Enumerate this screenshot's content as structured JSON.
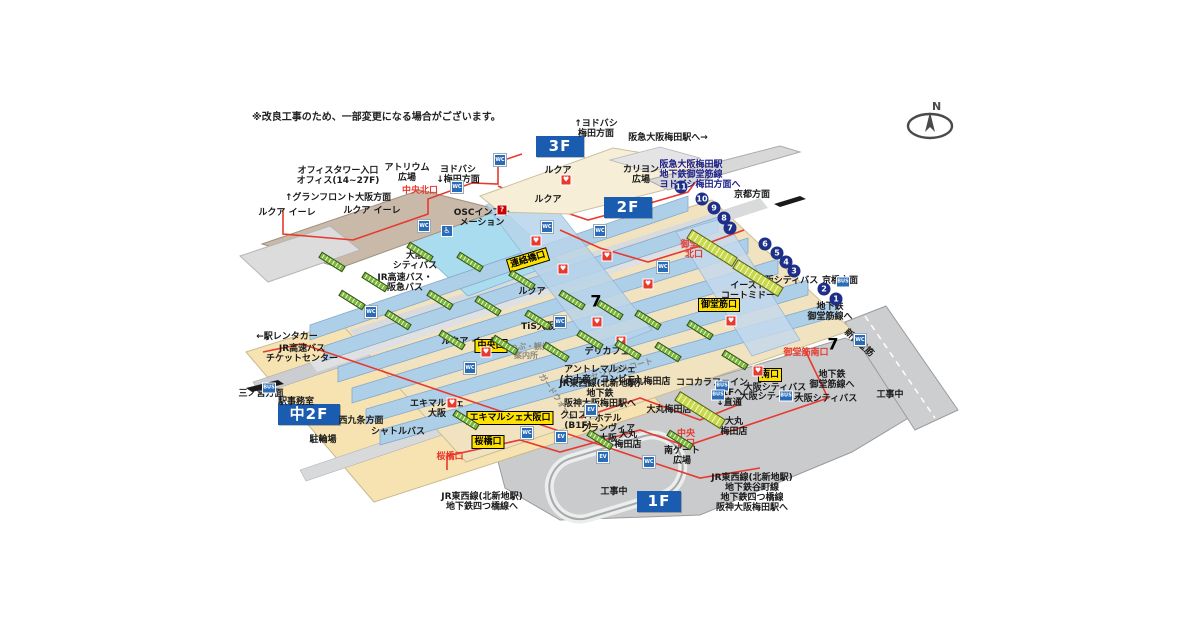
{
  "meta": {
    "title": "JR大阪駅 構内図(立体)",
    "note": "※改良工事のため、一部変更になる場合がございます。",
    "compass_label": "N"
  },
  "colors": {
    "floor_badge_blue": "#1a5cb0",
    "exit_badge_yellow": "#ffe100",
    "route_red": "#e8392e",
    "platform_blue": "#aecfe8",
    "concourse_beige": "#f2e3c0",
    "mezzanine_beige": "#f7e3b2",
    "road_gray": "#c9cbcd",
    "roof_cream": "#f6eed6",
    "roof_brown": "#c9b9a9",
    "atrium_cyan": "#a9dcee",
    "escalator_green": "#7db93c",
    "number_navy": "#1d2f88",
    "navy_text": "#1d2088"
  },
  "floor_badges": [
    {
      "name": "floor-badge-3f",
      "label": "3F",
      "x": 536,
      "y": 136,
      "w": 48
    },
    {
      "name": "floor-badge-2f",
      "label": "2F",
      "x": 604,
      "y": 197,
      "w": 48
    },
    {
      "name": "floor-badge-naka2f",
      "label": "中2F",
      "x": 278,
      "y": 404,
      "w": 62
    },
    {
      "name": "floor-badge-1f",
      "label": "1F",
      "x": 637,
      "y": 491,
      "w": 44
    }
  ],
  "labels": [
    {
      "name": "office-tower-entrance",
      "text": "オフィスタワー入口\nオフィス(14~27F)",
      "x": 338,
      "y": 177,
      "cls": "lbl"
    },
    {
      "name": "atrium-plaza",
      "text": "アトリウム\n広場",
      "x": 407,
      "y": 174,
      "cls": "lbl"
    },
    {
      "name": "yodobashi-umeda-down",
      "text": "ヨドバシ\n↓梅田方面",
      "x": 458,
      "y": 176,
      "cls": "lbl"
    },
    {
      "name": "chuo-north-exit",
      "text": "中央北口",
      "x": 420,
      "y": 192,
      "cls": "lbl-red"
    },
    {
      "name": "grand-front-osaka-direction",
      "text": "↑グランフロント大阪方面",
      "x": 338,
      "y": 199,
      "cls": "lbl"
    },
    {
      "name": "lucua-eere-west",
      "text": "ルクア イーレ",
      "x": 287,
      "y": 214,
      "cls": "lbl"
    },
    {
      "name": "lucua-eere-east",
      "text": "ルクア イーレ",
      "x": 372,
      "y": 212,
      "cls": "lbl"
    },
    {
      "name": "lucua-eere-mid",
      "text": "ルクア イーレ",
      "x": 470,
      "y": 343,
      "cls": "lbl"
    },
    {
      "name": "yodobashi-umeda-up",
      "text": "↑ヨドバシ\n梅田方面",
      "x": 596,
      "y": 130,
      "cls": "lbl"
    },
    {
      "name": "lucua-3f",
      "text": "ルクア",
      "x": 558,
      "y": 172,
      "cls": "lbl"
    },
    {
      "name": "lucua-2f",
      "text": "ルクア",
      "x": 548,
      "y": 201,
      "cls": "lbl"
    },
    {
      "name": "lucua-2f-lower",
      "text": "ルクア",
      "x": 532,
      "y": 293,
      "cls": "lbl"
    },
    {
      "name": "hankyu-osaka-umeda-sta",
      "text": "阪急大阪梅田駅へ→",
      "x": 668,
      "y": 139,
      "cls": "lbl"
    },
    {
      "name": "carillon-plaza",
      "text": "カリヨン\n広場",
      "x": 641,
      "y": 176,
      "cls": "lbl"
    },
    {
      "name": "hankyu-subway-yodobashi-route",
      "text": "阪急大阪梅田駅\n地下鉄御堂筋線\nヨドバシ梅田方面へ",
      "x": 700,
      "y": 176,
      "cls": "lbl-navy"
    },
    {
      "name": "kyoto-direction",
      "text": "京都方面",
      "x": 752,
      "y": 196,
      "cls": "lbl"
    },
    {
      "name": "osc-information",
      "text": "OSCインフォ\nメーション",
      "x": 482,
      "y": 219,
      "cls": "lbl"
    },
    {
      "name": "osaka-city-bus-west",
      "text": "大阪\nシティバス",
      "x": 415,
      "y": 262,
      "cls": "lbl"
    },
    {
      "name": "jr-highway-hankyu-bus",
      "text": "JR高速バス・\n阪急バス",
      "x": 405,
      "y": 284,
      "cls": "lbl"
    },
    {
      "name": "renrakubashi-exit",
      "text": "連絡橋口",
      "x": 528,
      "y": 260,
      "cls": "badge",
      "rot": -17
    },
    {
      "name": "midosuji-north-exit",
      "text": "御堂筋\n北口",
      "x": 694,
      "y": 251,
      "cls": "lbl-red"
    },
    {
      "name": "osaka-city-bus-east",
      "text": "大阪シティバス",
      "x": 787,
      "y": 282,
      "cls": "lbl"
    },
    {
      "name": "kyobashi-direction",
      "text": "京橋方面",
      "x": 840,
      "y": 282,
      "cls": "lbl"
    },
    {
      "name": "east-court-mido",
      "text": "イースト\nコートミドー",
      "x": 748,
      "y": 292,
      "cls": "lbl"
    },
    {
      "name": "subway-midosuji-northeast",
      "text": "地下鉄\n御堂筋線へ",
      "x": 830,
      "y": 313,
      "cls": "lbl"
    },
    {
      "name": "midosuji-exit",
      "text": "御堂筋口",
      "x": 719,
      "y": 305,
      "cls": "badge"
    },
    {
      "name": "shin-midosuji-road",
      "text": "新御堂筋",
      "x": 858,
      "y": 344,
      "cls": "lbl",
      "rot": 42
    },
    {
      "name": "midosuji-south-exit",
      "text": "御堂筋南口",
      "x": 806,
      "y": 354,
      "cls": "lbl-red"
    },
    {
      "name": "subway-midosuji-southeast",
      "text": "地下鉄\n御堂筋線へ",
      "x": 832,
      "y": 381,
      "cls": "lbl"
    },
    {
      "name": "under-construction-east",
      "text": "工事中",
      "x": 890,
      "y": 396,
      "cls": "lbl"
    },
    {
      "name": "minami-exit",
      "text": "南口",
      "x": 770,
      "y": 375,
      "cls": "badge"
    },
    {
      "name": "osaka-city-bus-south1",
      "text": "大阪シティバス",
      "x": 775,
      "y": 389,
      "cls": "lbl"
    },
    {
      "name": "osaka-city-bus-south2",
      "text": "大阪シティバス",
      "x": 771,
      "y": 398,
      "cls": "lbl"
    },
    {
      "name": "osaka-city-bus-south3",
      "text": "大阪シティバス",
      "x": 826,
      "y": 400,
      "cls": "lbl"
    },
    {
      "name": "cocokara-fine",
      "text": "ココカラファイン",
      "x": 712,
      "y": 384,
      "cls": "lbl"
    },
    {
      "name": "b1f-direct",
      "text": "B1Fへ\n↓直通",
      "x": 729,
      "y": 399,
      "cls": "lbl"
    },
    {
      "name": "deli-cafe",
      "text": "デリカフェ",
      "x": 607,
      "y": 353,
      "cls": "lbl"
    },
    {
      "name": "central-court",
      "text": "セントラルコート",
      "x": 622,
      "y": 370,
      "cls": "lbl-gray",
      "rot": -15
    },
    {
      "name": "daimaru-umeda-1",
      "text": "大丸梅田店",
      "x": 648,
      "y": 383,
      "cls": "lbl"
    },
    {
      "name": "daimaru-umeda-2",
      "text": "大丸梅田店",
      "x": 669,
      "y": 411,
      "cls": "lbl"
    },
    {
      "name": "daimaru-umeda-3",
      "text": "大丸\n梅田店",
      "x": 628,
      "y": 441,
      "cls": "lbl"
    },
    {
      "name": "daimaru-umeda-4",
      "text": "大丸\n梅田店",
      "x": 734,
      "y": 428,
      "cls": "lbl"
    },
    {
      "name": "entree-marche",
      "text": "アントレマルシェ\n(お土産・コンビニ)",
      "x": 600,
      "y": 376,
      "cls": "lbl"
    },
    {
      "name": "jr-tozai-route-center",
      "text": "JR東西線(北新地駅)\n地下鉄\n阪神大阪梅田駅へ",
      "x": 600,
      "y": 395,
      "cls": "lbl"
    },
    {
      "name": "gard-walk",
      "text": "ガードウォーク",
      "x": 556,
      "y": 398,
      "cls": "lbl-gray",
      "rot": 55
    },
    {
      "name": "crost-b1f",
      "text": "クロスト\n(B1F)",
      "x": 578,
      "y": 422,
      "cls": "lbl"
    },
    {
      "name": "hotel-granvia-osaka",
      "text": "ホテル\nグランヴィア\n大阪",
      "x": 608,
      "y": 430,
      "cls": "lbl"
    },
    {
      "name": "chuo-south-exit",
      "text": "中央\n南口",
      "x": 686,
      "y": 440,
      "cls": "lbl-red"
    },
    {
      "name": "south-gate-plaza",
      "text": "南ゲート\n広場",
      "x": 682,
      "y": 457,
      "cls": "lbl"
    },
    {
      "name": "jr-tozai-route-southeast",
      "text": "JR東西線(北新地駅)\n地下鉄谷町線\n地下鉄四つ橋線\n阪神大阪梅田駅へ",
      "x": 752,
      "y": 494,
      "cls": "lbl"
    },
    {
      "name": "jr-tozai-route-southwest",
      "text": "JR東西線(北新地駅)\n地下鉄四つ橋線へ",
      "x": 482,
      "y": 503,
      "cls": "lbl"
    },
    {
      "name": "under-construction-south",
      "text": "工事中",
      "x": 614,
      "y": 493,
      "cls": "lbl"
    },
    {
      "name": "station-rentacar",
      "text": "←駅レンタカー",
      "x": 287,
      "y": 338,
      "cls": "lbl"
    },
    {
      "name": "jr-highway-bus-ticket-center",
      "text": "JR高速バス\nチケットセンター",
      "x": 302,
      "y": 355,
      "cls": "lbl"
    },
    {
      "name": "sannomiya-direction",
      "text": "三ノ宮方面",
      "x": 261,
      "y": 395,
      "cls": "lbl"
    },
    {
      "name": "station-office",
      "text": "駅事務室",
      "x": 296,
      "y": 403,
      "cls": "lbl"
    },
    {
      "name": "nishikujo-direction",
      "text": "西九条方面",
      "x": 361,
      "y": 422,
      "cls": "lbl"
    },
    {
      "name": "shuttle-bus",
      "text": "シャトルバス",
      "x": 398,
      "y": 433,
      "cls": "lbl"
    },
    {
      "name": "bicycle-parking",
      "text": "駐輪場",
      "x": 323,
      "y": 441,
      "cls": "lbl"
    },
    {
      "name": "ekimaruche-osaka",
      "text": "エキマルシェ\n大阪",
      "x": 437,
      "y": 410,
      "cls": "lbl"
    },
    {
      "name": "ekimaruche-osaka-exit",
      "text": "エキマルシェ大阪口",
      "x": 510,
      "y": 418,
      "cls": "badge"
    },
    {
      "name": "sakurabashi-exit-badge",
      "text": "桜橋口",
      "x": 488,
      "y": 442,
      "cls": "badge"
    },
    {
      "name": "sakurabashi-exit-red",
      "text": "桜橋口",
      "x": 450,
      "y": 458,
      "cls": "lbl-red"
    },
    {
      "name": "chuo-exit",
      "text": "中央口",
      "x": 491,
      "y": 346,
      "cls": "badge"
    },
    {
      "name": "tis-osaka",
      "text": "TiS大阪",
      "x": 538,
      "y": 328,
      "cls": "lbl"
    },
    {
      "name": "ticket-tourist-info",
      "text": "きっぷ・観光\n案内所",
      "x": 526,
      "y": 352,
      "cls": "lbl-gray"
    }
  ],
  "platform_numbers": [
    {
      "n": "11",
      "x": 681,
      "y": 187
    },
    {
      "n": "10",
      "x": 702,
      "y": 199
    },
    {
      "n": "9",
      "x": 714,
      "y": 208
    },
    {
      "n": "8",
      "x": 724,
      "y": 218
    },
    {
      "n": "7",
      "x": 730,
      "y": 228
    },
    {
      "n": "6",
      "x": 765,
      "y": 244
    },
    {
      "n": "5",
      "x": 777,
      "y": 253
    },
    {
      "n": "4",
      "x": 786,
      "y": 262
    },
    {
      "n": "3",
      "x": 794,
      "y": 271
    },
    {
      "n": "2",
      "x": 824,
      "y": 289
    },
    {
      "n": "1",
      "x": 836,
      "y": 299
    }
  ],
  "icon_glyphs": {
    "restroom": "WC",
    "elevator": "EV",
    "aed": "♥",
    "info": "?",
    "seven-eleven": "7",
    "bus": "BUS",
    "wheelchair": "♿"
  },
  "icons": [
    {
      "type": "restroom",
      "x": 500,
      "y": 160
    },
    {
      "type": "restroom",
      "x": 457,
      "y": 187
    },
    {
      "type": "restroom",
      "x": 424,
      "y": 226
    },
    {
      "type": "restroom",
      "x": 547,
      "y": 227
    },
    {
      "type": "restroom",
      "x": 600,
      "y": 231
    },
    {
      "type": "restroom",
      "x": 663,
      "y": 267
    },
    {
      "type": "restroom",
      "x": 560,
      "y": 322
    },
    {
      "type": "restroom",
      "x": 371,
      "y": 312
    },
    {
      "type": "restroom",
      "x": 470,
      "y": 368
    },
    {
      "type": "restroom",
      "x": 527,
      "y": 433
    },
    {
      "type": "restroom",
      "x": 649,
      "y": 462
    },
    {
      "type": "restroom",
      "x": 860,
      "y": 340
    },
    {
      "type": "wheelchair",
      "x": 447,
      "y": 231
    },
    {
      "type": "elevator",
      "x": 561,
      "y": 437
    },
    {
      "type": "elevator",
      "x": 603,
      "y": 457
    },
    {
      "type": "elevator",
      "x": 591,
      "y": 410
    },
    {
      "type": "aed",
      "x": 536,
      "y": 241
    },
    {
      "type": "aed",
      "x": 563,
      "y": 269
    },
    {
      "type": "aed",
      "x": 597,
      "y": 322
    },
    {
      "type": "aed",
      "x": 648,
      "y": 284
    },
    {
      "type": "aed",
      "x": 731,
      "y": 321
    },
    {
      "type": "aed",
      "x": 758,
      "y": 371
    },
    {
      "type": "aed",
      "x": 486,
      "y": 352
    },
    {
      "type": "aed",
      "x": 452,
      "y": 403
    },
    {
      "type": "aed",
      "x": 607,
      "y": 256
    },
    {
      "type": "aed",
      "x": 566,
      "y": 180
    },
    {
      "type": "aed",
      "x": 621,
      "y": 341
    },
    {
      "type": "info",
      "x": 502,
      "y": 210
    },
    {
      "type": "seven-eleven",
      "x": 596,
      "y": 301
    },
    {
      "type": "seven-eleven",
      "x": 833,
      "y": 344
    },
    {
      "type": "bus",
      "x": 722,
      "y": 386
    },
    {
      "type": "bus",
      "x": 718,
      "y": 395
    },
    {
      "type": "bus",
      "x": 786,
      "y": 396
    },
    {
      "type": "bus",
      "x": 843,
      "y": 282
    },
    {
      "type": "bus",
      "x": 269,
      "y": 388
    }
  ],
  "escalators": [
    {
      "x": 332,
      "y": 262
    },
    {
      "x": 352,
      "y": 300
    },
    {
      "x": 375,
      "y": 282
    },
    {
      "x": 398,
      "y": 320
    },
    {
      "x": 420,
      "y": 252
    },
    {
      "x": 440,
      "y": 300
    },
    {
      "x": 452,
      "y": 340
    },
    {
      "x": 470,
      "y": 262
    },
    {
      "x": 488,
      "y": 306
    },
    {
      "x": 505,
      "y": 345
    },
    {
      "x": 522,
      "y": 280
    },
    {
      "x": 538,
      "y": 320
    },
    {
      "x": 556,
      "y": 352
    },
    {
      "x": 572,
      "y": 300
    },
    {
      "x": 590,
      "y": 340
    },
    {
      "x": 610,
      "y": 310
    },
    {
      "x": 628,
      "y": 350
    },
    {
      "x": 648,
      "y": 320
    },
    {
      "x": 668,
      "y": 352
    },
    {
      "x": 700,
      "y": 330
    },
    {
      "x": 735,
      "y": 360
    },
    {
      "x": 600,
      "y": 440
    },
    {
      "x": 680,
      "y": 440
    },
    {
      "x": 466,
      "y": 420
    },
    {
      "x": 712,
      "y": 248,
      "wide": true
    },
    {
      "x": 758,
      "y": 278,
      "wide": true
    },
    {
      "x": 700,
      "y": 410,
      "wide": true
    }
  ]
}
